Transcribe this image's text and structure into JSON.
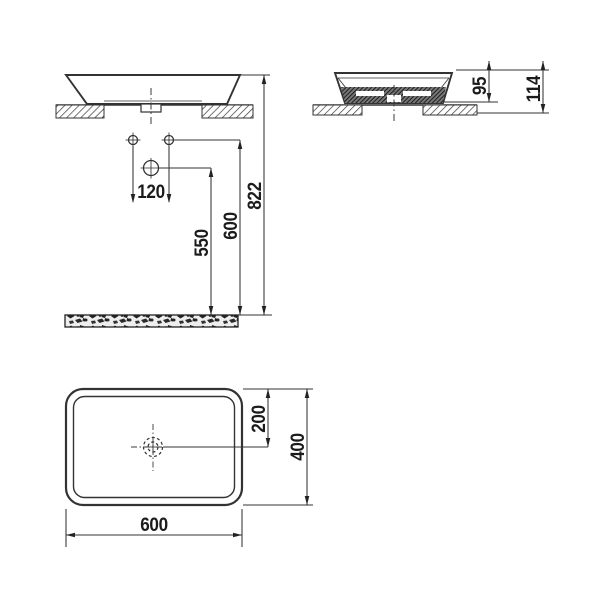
{
  "drawing": {
    "type": "washbasin technical dimension drawing",
    "front_view": {
      "dim_hole_spacing": "120",
      "dim_drain_height": "550",
      "dim_holes_height": "600",
      "dim_overall_height": "822"
    },
    "side_view": {
      "dim_basin_above_counter": "95",
      "dim_basin_total_height": "114"
    },
    "plan_view": {
      "dim_drain_from_back": "200",
      "dim_depth": "400",
      "dim_width": "600"
    },
    "colors": {
      "line": "#333333",
      "text": "#1b1b1b",
      "background": "#ffffff"
    }
  }
}
